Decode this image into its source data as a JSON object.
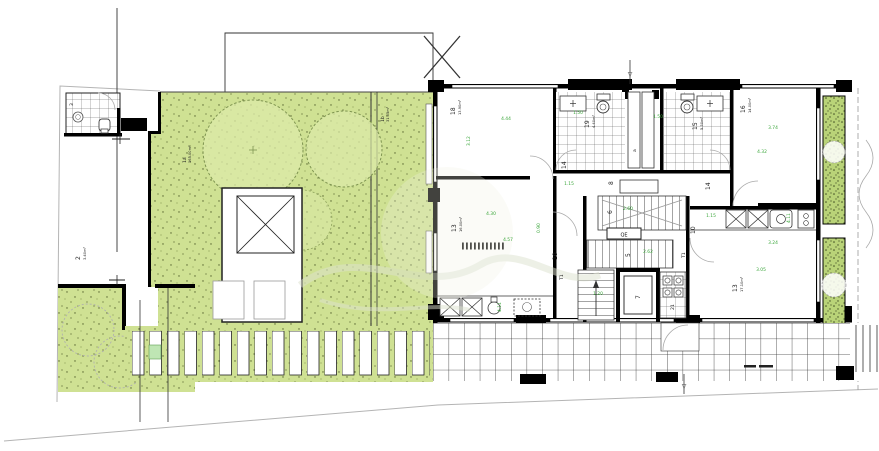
{
  "plan": {
    "type": "architectural-floor-plan",
    "room_labels": [
      {
        "number": "18",
        "area": "13.90m²"
      },
      {
        "number": "19",
        "area": "4.40m²"
      },
      {
        "number": "15",
        "area": "5.30m²"
      },
      {
        "number": "16",
        "area": "14.00m²"
      },
      {
        "number": "13",
        "area": "16.00m²"
      },
      {
        "number": "13",
        "area": "17.10m²"
      },
      {
        "number": "14"
      },
      {
        "number": "14"
      },
      {
        "number": "10"
      },
      {
        "number": "10"
      },
      {
        "number": "8"
      },
      {
        "number": "6"
      },
      {
        "number": "5"
      },
      {
        "number": "7"
      },
      {
        "number": "21"
      },
      {
        "number": "T1"
      },
      {
        "number": "T1"
      },
      {
        "number": "a"
      },
      {
        "number": "QE"
      },
      {
        "number": "1a",
        "area": "165.00m²"
      },
      {
        "number": "1b",
        "area": "31.05m²"
      },
      {
        "number": "2",
        "area": "3.40m²"
      },
      {
        "number": "3"
      }
    ],
    "dimensions": [
      "4.44",
      "3.12",
      "1.50",
      "1.50",
      "3.74",
      "4.32",
      "1.15",
      "1.15",
      "4.30",
      "4.57",
      "3.24",
      "3.05",
      "2.62",
      "1.20",
      "4.11",
      "4.11",
      "0.90",
      "2.60"
    ],
    "symbols": {
      "level_marker": "▽"
    },
    "colors": {
      "garden_green": "#cfe193",
      "planter_green": "#b9d378",
      "dimension_green": "#3aa63a",
      "wall_black": "#000000",
      "boundary_gray": "#b4b4b4"
    }
  }
}
